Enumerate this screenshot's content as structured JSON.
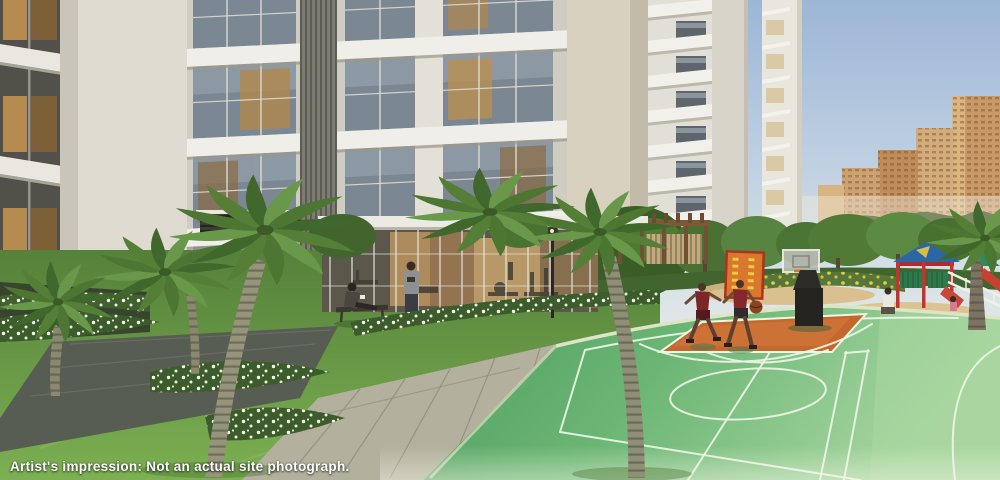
{
  "caption": "Artist's impression: Not an actual site photograph.",
  "scene": {
    "type": "architectural rendering",
    "setting": "Landscaped podium courtyard of a residential high-rise complex in daylight",
    "visible_people_count": 6,
    "elements": [
      {
        "name": "main-residential-tower",
        "description": "White high-rise facade with floor slabs, glass windows, amber curtains and a vertical louvre stack"
      },
      {
        "name": "mid-tower-left",
        "description": "Slim white tower with stacked projecting balcony slabs and dark window slots"
      },
      {
        "name": "mid-tower-right",
        "description": "Slim white tower with warm balcony panels"
      },
      {
        "name": "distant-city-towers",
        "description": "Tan and orange high-rise buildings on the hazy horizon"
      },
      {
        "name": "horizon-treeline",
        "description": "Soft green tree line below the distant towers"
      },
      {
        "name": "gym-clubhouse",
        "description": "Glass-walled ground-floor gym with warm wood interior and exercise equipment"
      },
      {
        "name": "basketball-court",
        "description": "Green outdoor court with white markings and an orange painted key"
      },
      {
        "name": "basketball-hoop",
        "description": "Portable basketball stand with backboard, orange rim and black base"
      },
      {
        "name": "basketball-player-left",
        "description": "Player in maroon jersey running"
      },
      {
        "name": "basketball-player-right",
        "description": "Player in maroon jersey dribbling a basketball"
      },
      {
        "name": "climbing-board",
        "description": "Orange climbing panel with yellow holds and red frame"
      },
      {
        "name": "playground-structure",
        "description": "Children's play set with blue canopy, red posts, green rails and a sand pit"
      },
      {
        "name": "playground-slide",
        "description": "Second play unit with green canopy and red slide behind a white railing"
      },
      {
        "name": "kneeling-adult",
        "description": "Adult in white kneeling beside the sand pit with a child"
      },
      {
        "name": "child",
        "description": "Small child in pink near the playground"
      },
      {
        "name": "seated-woman",
        "description": "Woman seated on a dark bench on the lawn"
      },
      {
        "name": "standing-man",
        "description": "Man in grey t-shirt standing on the lawn"
      },
      {
        "name": "pergola",
        "description": "Timber pergola with bamboo screen between the towers"
      },
      {
        "name": "palm-trees",
        "description": "Royal palms with ringed trunks across the landscape"
      },
      {
        "name": "flower-beds",
        "description": "Beds of small white flowers edging the walkways"
      },
      {
        "name": "yellow-flower-hedge",
        "description": "Hedge with yellow blooms behind the court"
      },
      {
        "name": "dark-walkway",
        "description": "Dark stone pathway crossing the lawn"
      },
      {
        "name": "paver-walkway",
        "description": "Light concrete paver path leading to the court"
      },
      {
        "name": "lawn",
        "description": "Manicured green lawn"
      },
      {
        "name": "lamp-post",
        "description": "Slim garden lamp post by the gym"
      },
      {
        "name": "bench",
        "description": "Dark garden bench"
      },
      {
        "name": "sky",
        "description": "Clear pale-blue sky, hazy near the horizon"
      }
    ]
  },
  "palette": {
    "caption_text": "#ffffff",
    "sky_top": "#9cb6d6",
    "sky_horizon": "#f4f2e6",
    "tower_wall": "#e6e3da",
    "tower_wall_shadow": "#c7c3b8",
    "tower_beige_wall": "#d8d0bf",
    "window_glass": "#7b8894",
    "window_warm_amber": "#b58c50",
    "balcony_slab": "#f0eee8",
    "lawn_green": "#6ba04a",
    "lawn_green_dark": "#4e7c34",
    "court_green": "#5fa96b",
    "court_green_light": "#a8d6a0",
    "court_key_orange": "#c4682e",
    "court_line": "#ecf5e6",
    "curb_concrete": "#dce5c6",
    "path_dark_grey": "#585d54",
    "path_paver_light": "#b3b09e",
    "palm_frond_green": "#557f37",
    "palm_trunk": "#96957c",
    "flower_white": "#f5f7ef",
    "flower_yellow": "#e6cf46",
    "hedge_green_dark": "#3c5c2c",
    "distant_city_tan": "#c89a66",
    "treeline_green": "#7b8c64",
    "gym_interior_amber": "#c89a58",
    "gym_wood": "#a87c46",
    "playground_red": "#c23430",
    "playground_blue": "#2b67a4",
    "playground_green": "#2e7a4c",
    "sand_tan": "#d9c08e",
    "jersey_maroon": "#7c262a",
    "basketball_orange": "#8a4420",
    "backboard_rim_orange": "#d8742c"
  }
}
